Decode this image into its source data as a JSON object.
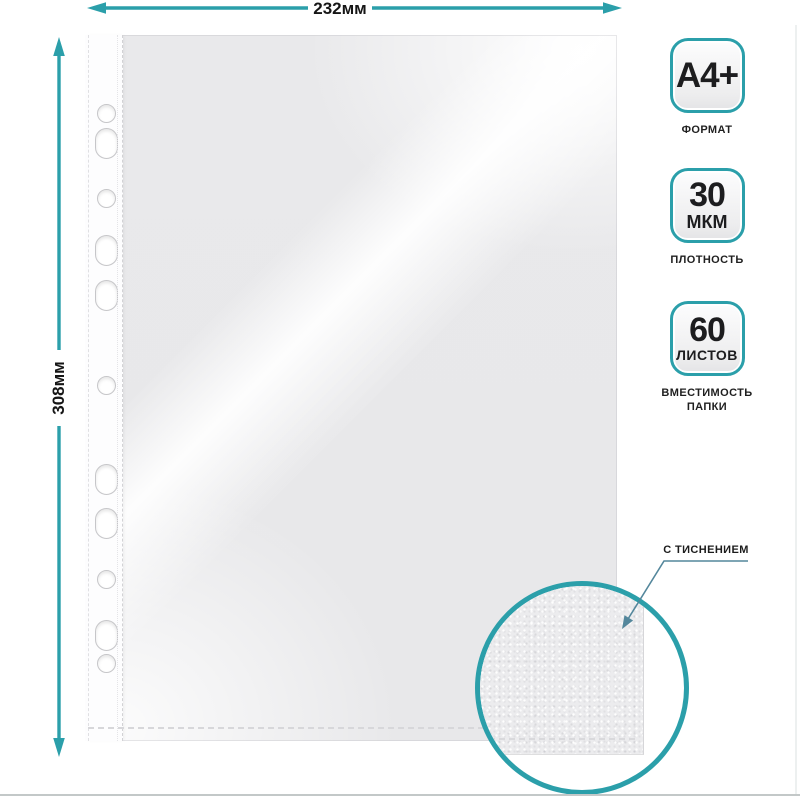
{
  "colors": {
    "accent": "#2b9faa",
    "callout_line": "#54879c"
  },
  "dimension_annotations": {
    "width": "232мм",
    "height": "308мм"
  },
  "spec_badges": [
    {
      "value": "A4+",
      "unit": "",
      "caption": "ФОРМАТ"
    },
    {
      "value": "30",
      "unit": "МКМ",
      "caption": "ПЛОТНОСТЬ"
    },
    {
      "value": "60",
      "unit": "ЛИСТОВ",
      "caption": "ВМЕСТИМОСТЬ ПАПКИ"
    }
  ],
  "embossing_callout": {
    "label": "С ТИСНЕНИЕМ"
  },
  "sheet": {
    "punch_holes_count": 11
  }
}
